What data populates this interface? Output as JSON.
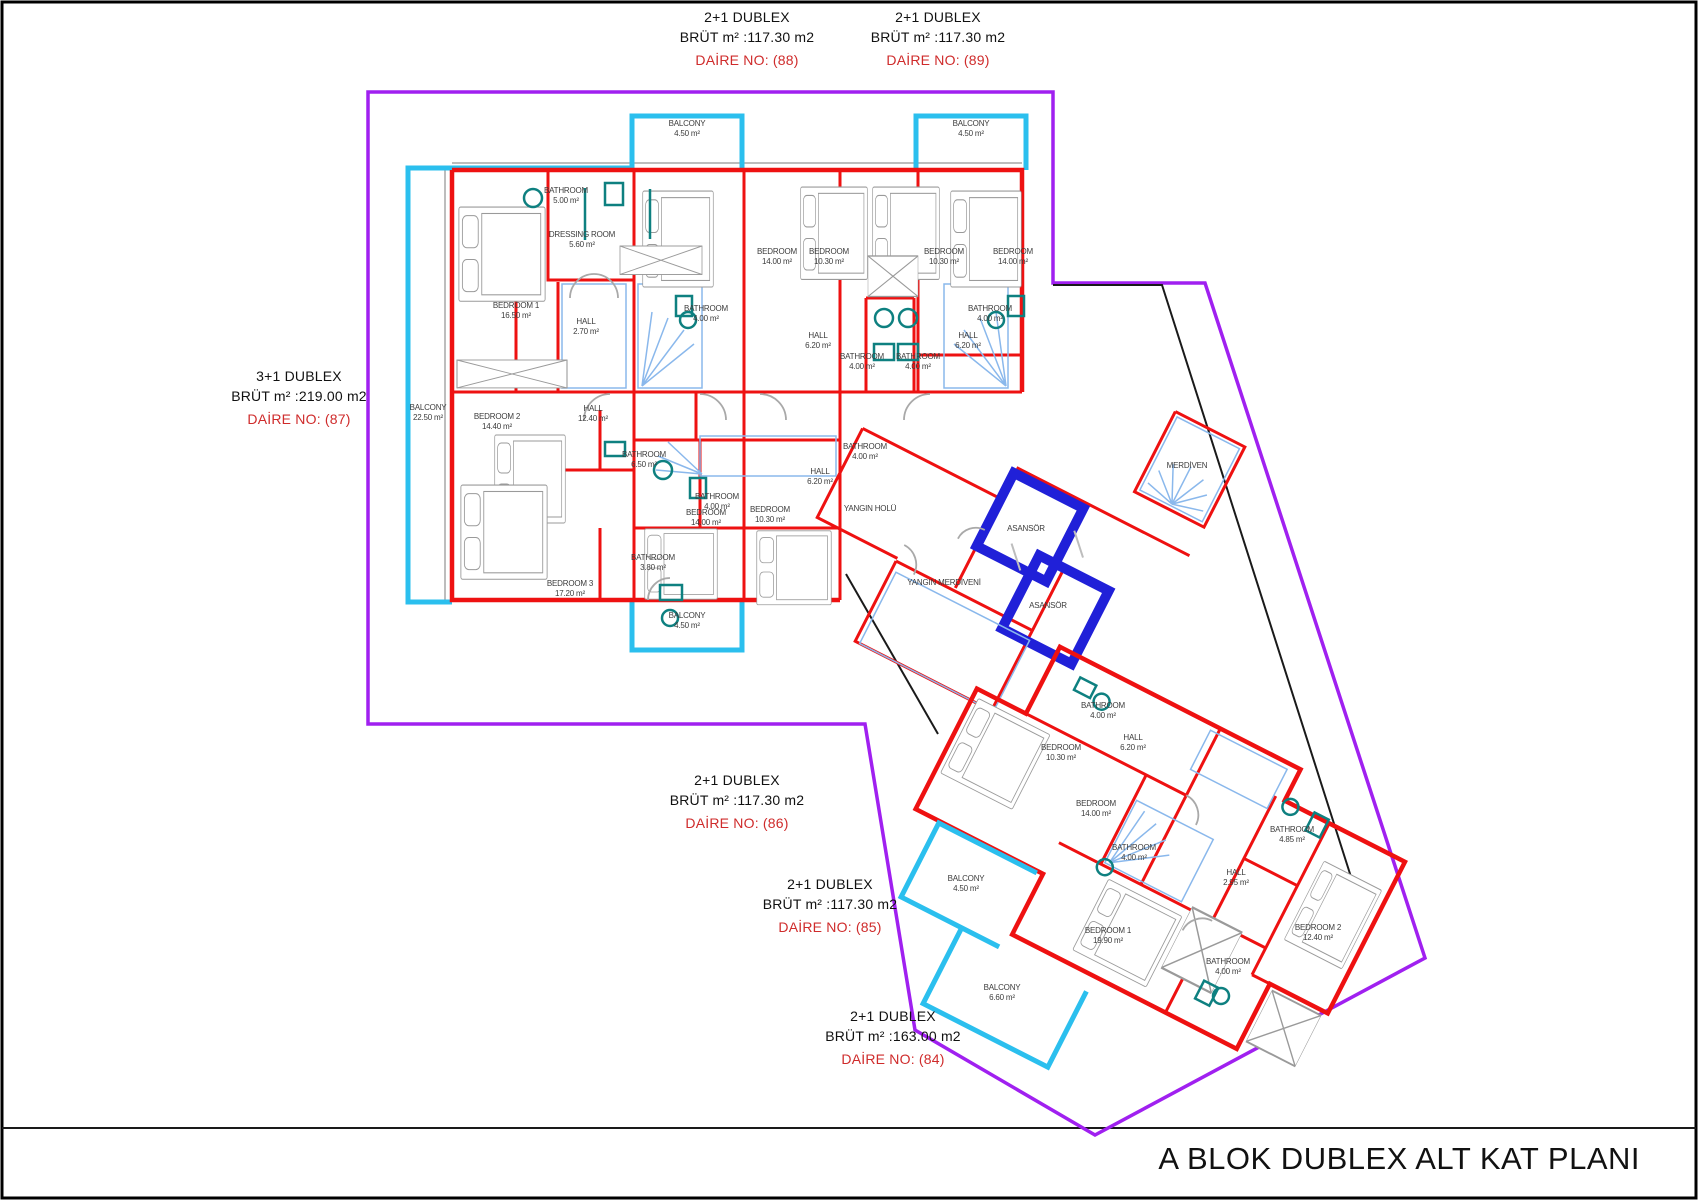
{
  "sheet": {
    "title": "A BLOK DUBLEX ALT KAT PL ANI",
    "title_fixed": "A BLOK DUBLEX ALT KAT PLANI"
  },
  "colors": {
    "wall_red": "#ee1111",
    "balcony_cyan": "#2bbfee",
    "site_boundary_purple": "#a020f0",
    "elevator_blue": "#2020d8",
    "stair_blue": "#8ab8ec",
    "fixture_teal": "#0e8080",
    "furniture_gray": "#9a9a9a",
    "apartment_no_red": "#cf2b2b"
  },
  "apartments": [
    {
      "type": "2+1 DUBLEX",
      "brut": "BRÜT m² :117.30 m2",
      "daire": "DAİRE NO: (88)"
    },
    {
      "type": "2+1 DUBLEX",
      "brut": "BRÜT m² :117.30 m2",
      "daire": "DAİRE NO: (89)"
    },
    {
      "type": "3+1 DUBLEX",
      "brut": "BRÜT m² :219.00 m2",
      "daire": "DAİRE NO: (87)"
    },
    {
      "type": "2+1 DUBLEX",
      "brut": "BRÜT m² :117.30 m2",
      "daire": "DAİRE NO: (86)"
    },
    {
      "type": "2+1 DUBLEX",
      "brut": "BRÜT m² :117.30 m2",
      "daire": "DAİRE NO: (85)"
    },
    {
      "type": "2+1 DUBLEX",
      "brut": "BRÜT m² :163.00 m2",
      "daire": "DAİRE NO: (84)"
    }
  ],
  "rooms": [
    {
      "name": "BALCONY",
      "area": "22.50 m²",
      "x": 428,
      "y": 410
    },
    {
      "name": "BATHROOM",
      "area": "5.00 m²",
      "x": 566,
      "y": 193
    },
    {
      "name": "DRESSING ROOM",
      "area": "5.60 m²",
      "x": 582,
      "y": 237
    },
    {
      "name": "BEDROOM 1",
      "area": "16.50 m²",
      "x": 516,
      "y": 308
    },
    {
      "name": "HALL",
      "area": "2.70 m²",
      "x": 586,
      "y": 324
    },
    {
      "name": "BEDROOM 2",
      "area": "14.40 m²",
      "x": 497,
      "y": 419
    },
    {
      "name": "HALL",
      "area": "12.40 m²",
      "x": 593,
      "y": 411
    },
    {
      "name": "BATHROOM",
      "area": "6.50 m²",
      "x": 644,
      "y": 457
    },
    {
      "name": "BATHROOM",
      "area": "3.80 m²",
      "x": 653,
      "y": 560
    },
    {
      "name": "BEDROOM 3",
      "area": "17.20 m²",
      "x": 570,
      "y": 586
    },
    {
      "name": "BALCONY",
      "area": "4.50 m²",
      "x": 687,
      "y": 126
    },
    {
      "name": "BALCONY",
      "area": "4.50 m²",
      "x": 971,
      "y": 126
    },
    {
      "name": "BEDROOM",
      "area": "14.00 m²",
      "x": 777,
      "y": 254
    },
    {
      "name": "BEDROOM",
      "area": "10.30 m²",
      "x": 829,
      "y": 254
    },
    {
      "name": "BEDROOM",
      "area": "10.30 m²",
      "x": 944,
      "y": 254
    },
    {
      "name": "BEDROOM",
      "area": "14.00 m²",
      "x": 1013,
      "y": 254
    },
    {
      "name": "BATHROOM",
      "area": "4.00 m²",
      "x": 706,
      "y": 311
    },
    {
      "name": "BATHROOM",
      "area": "4.00 m²",
      "x": 990,
      "y": 311
    },
    {
      "name": "HALL",
      "area": "6.20 m²",
      "x": 818,
      "y": 338
    },
    {
      "name": "HALL",
      "area": "6.20 m²",
      "x": 968,
      "y": 338
    },
    {
      "name": "BATHROOM",
      "area": "4.00 m²",
      "x": 862,
      "y": 359
    },
    {
      "name": "BATHROOM",
      "area": "4.00 m²",
      "x": 918,
      "y": 359
    },
    {
      "name": "BATHROOM",
      "area": "4.00 m²",
      "x": 717,
      "y": 499
    },
    {
      "name": "HALL",
      "area": "6.20 m²",
      "x": 820,
      "y": 474
    },
    {
      "name": "BEDROOM",
      "area": "14.00 m²",
      "x": 706,
      "y": 515
    },
    {
      "name": "BEDROOM",
      "area": "10.30 m²",
      "x": 770,
      "y": 512
    },
    {
      "name": "BALCONY",
      "area": "4.50 m²",
      "x": 687,
      "y": 618
    },
    {
      "name": "BATHROOM",
      "area": "4.00 m²",
      "x": 865,
      "y": 449
    },
    {
      "name": "YANGIN HOLÜ",
      "area": "",
      "x": 870,
      "y": 511
    },
    {
      "name": "YANGIN MERDİVENİ",
      "area": "",
      "x": 944,
      "y": 585
    },
    {
      "name": "ASANSÖR",
      "area": "",
      "x": 1026,
      "y": 531
    },
    {
      "name": "ASANSÖR",
      "area": "",
      "x": 1048,
      "y": 608
    },
    {
      "name": "MERDİVEN",
      "area": "",
      "x": 1187,
      "y": 468
    },
    {
      "name": "BATHROOM",
      "area": "4.00 m²",
      "x": 1103,
      "y": 708
    },
    {
      "name": "HALL",
      "area": "6.20 m²",
      "x": 1133,
      "y": 740
    },
    {
      "name": "BEDROOM",
      "area": "10.30 m²",
      "x": 1061,
      "y": 750
    },
    {
      "name": "BEDROOM",
      "area": "14.00 m²",
      "x": 1096,
      "y": 806
    },
    {
      "name": "BATHROOM",
      "area": "4.00 m²",
      "x": 1134,
      "y": 850
    },
    {
      "name": "BATHROOM",
      "area": "4.85 m²",
      "x": 1292,
      "y": 832
    },
    {
      "name": "HALL",
      "area": "2.95 m²",
      "x": 1236,
      "y": 875
    },
    {
      "name": "BEDROOM 1",
      "area": "19.90 m²",
      "x": 1108,
      "y": 933
    },
    {
      "name": "BEDROOM 2",
      "area": "12.40 m²",
      "x": 1318,
      "y": 930
    },
    {
      "name": "BATHROOM",
      "area": "4.00 m²",
      "x": 1228,
      "y": 964
    },
    {
      "name": "BALCONY",
      "area": "4.50 m²",
      "x": 966,
      "y": 881
    },
    {
      "name": "BALCONY",
      "area": "6.60 m²",
      "x": 1002,
      "y": 990
    }
  ]
}
